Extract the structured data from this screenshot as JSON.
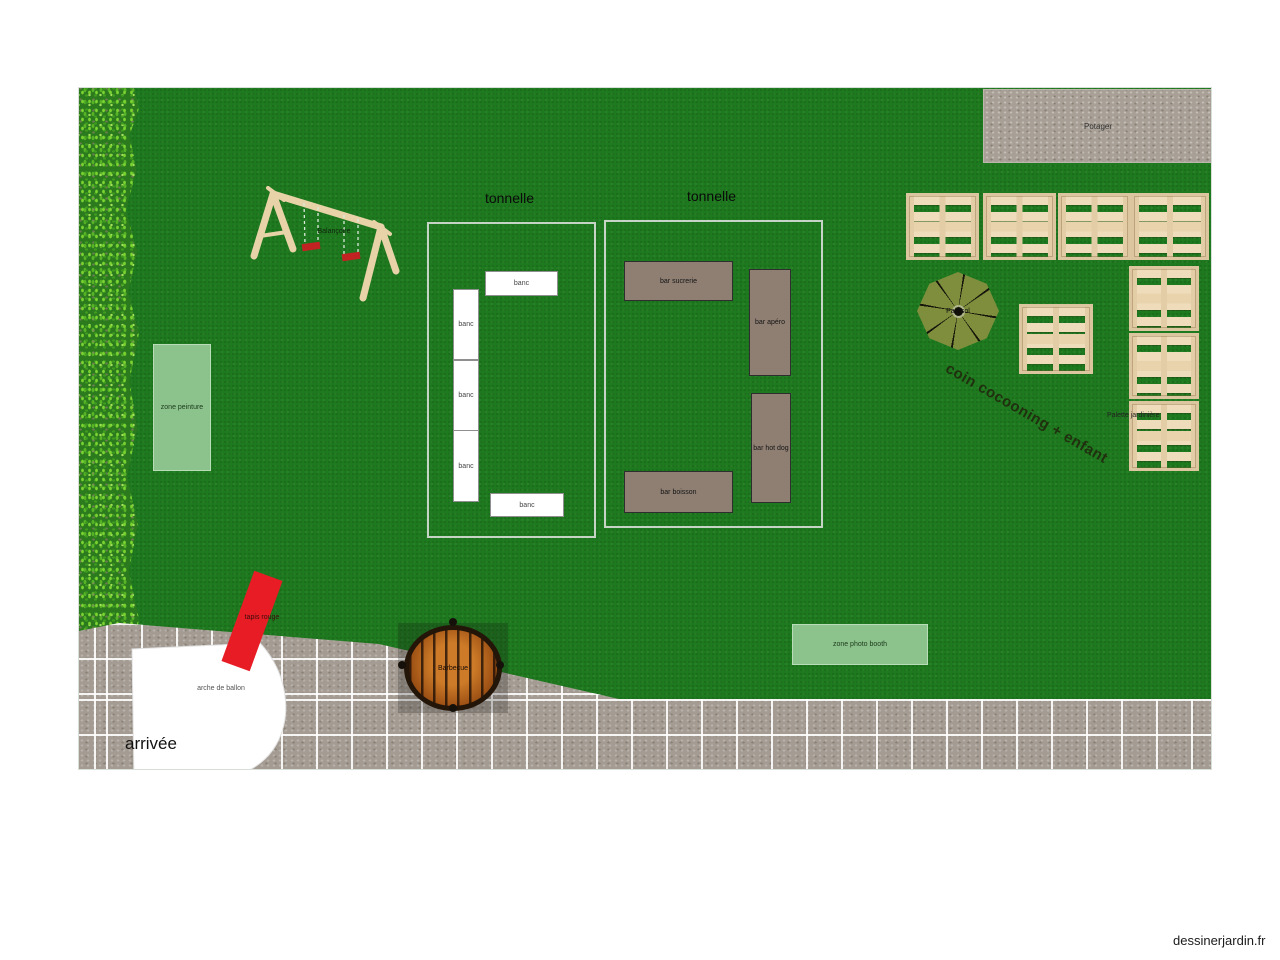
{
  "garden": {
    "potager": {
      "label": "Potager"
    },
    "swing": {
      "label": "Balançoire"
    },
    "tonnelle_left": {
      "title": "tonnelle",
      "benches": [
        "banc",
        "banc",
        "banc",
        "banc",
        "banc"
      ]
    },
    "tonnelle_right": {
      "title": "tonnelle",
      "bars": [
        "bar sucrerie",
        "bar apéro",
        "bar hot dog",
        "bar boisson"
      ]
    },
    "parasol": {
      "label": "Parasol"
    },
    "cocooning": {
      "label": "coin cocooning + enfant"
    },
    "palettes": {
      "label": "Palette jardinière"
    },
    "zone_peinture": {
      "label": "zone peinture"
    },
    "zone_photo": {
      "label": "zone photo booth"
    },
    "carpet": {
      "label": "tapis rouge"
    },
    "arch": {
      "label": "arche de ballon"
    },
    "barbecue": {
      "label": "Barbecue"
    },
    "arrivee": {
      "label": "arrivée"
    }
  },
  "colors": {
    "lawn": "#1e7a1e",
    "path": "#a49c93",
    "bar": "#8f7f73",
    "zone": "#8cc28c",
    "carpet": "#e81c24",
    "parasol": "#7e8e3c",
    "pallet": "#e8d5b0",
    "bench": "#ffffff"
  },
  "site": {
    "watermark": "dessinerjardin.fr"
  }
}
